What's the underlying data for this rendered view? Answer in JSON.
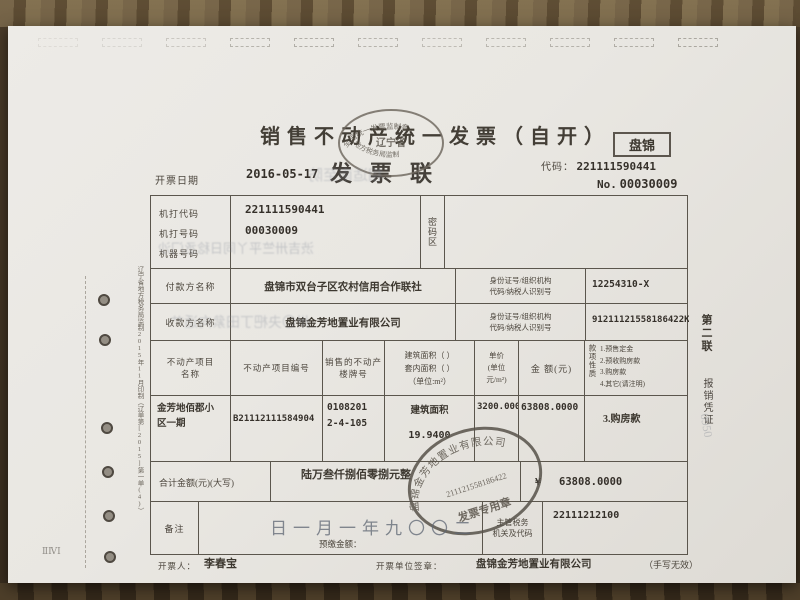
{
  "invoice": {
    "title": "销售不动产统一发票（自开）",
    "copy_label": "发票联",
    "region": "盘锦",
    "code_label": "代码：",
    "code": "221111590441",
    "number_label": "No.",
    "number": "00030009",
    "issue_date_label": "开票日期",
    "issue_date": "2016-05-17"
  },
  "supervision_stamp": {
    "arc_top": "全国统一发票监制章",
    "center": "辽宁省",
    "arc_bottom": "地方税务局监制"
  },
  "machine_info": {
    "label_code": "机打代码",
    "label_number": "机打号码",
    "label_machine": "机器号码",
    "code": "221111590441",
    "number": "00030009",
    "password_area_label": "密码区"
  },
  "parties": {
    "payer": {
      "label": "付款方名称",
      "name": "盘锦市双台子区农村信用合作联社",
      "id_label_line1": "身份证号/组织机构",
      "id_label_line2": "代码/纳税人识别号",
      "id": "12254310-X"
    },
    "payee": {
      "label": "收款方名称",
      "name": "盘锦金芳地置业有限公司",
      "id_label_line1": "身份证号/组织机构",
      "id_label_line2": "代码/纳税人识别号",
      "id": "91211121558186422K"
    }
  },
  "items": {
    "headers": {
      "project_name_line1": "不动产项目",
      "project_name_line2": "名称",
      "project_no": "不动产项目编号",
      "building_no_line1": "销售的不动产",
      "building_no_line2": "楼牌号",
      "area_line1": "建筑面积（ ）",
      "area_line2": "套内面积（ ）",
      "area_line3": "（单位:m²）",
      "unit_price_line1": "单价",
      "unit_price_line2": "(单位",
      "unit_price_line3": "元/m²)",
      "amount": "金 额(元)",
      "payment_nature_label": "款项性质",
      "payment_option_1": "1.预售定金",
      "payment_option_2": "2.预收购房款",
      "payment_option_3": "3.购房款",
      "payment_option_4": "4.其它(请注明)"
    },
    "row": {
      "project_name_line1": "金芳地佰郡小",
      "project_name_line2": "区一期",
      "project_no": "B21112111584904",
      "building_no_line1": "0108201",
      "building_no_line2": "2-4-105",
      "area_caption": "建筑面积",
      "area_value": "19.9400",
      "unit_price": "3200.0000",
      "amount": "63808.0000",
      "payment_nature": "3.购房款"
    }
  },
  "totals": {
    "label": "合计金额(元)(大写)",
    "in_words": "陆万叁仟捌佰零捌元整",
    "currency_symbol": "¥",
    "numeric": "63808.0000"
  },
  "remarks": {
    "label": "备注",
    "prepaid_label": "预缴金额：",
    "tax_authority_line1": "主管税务",
    "tax_authority_line2": "机关及代码",
    "tax_authority_code": "22111212100"
  },
  "company_stamp": {
    "arc": "盘锦金芳地置业有限公司",
    "center": "211121558186422",
    "caption": "发票专用章"
  },
  "footer": {
    "issuer_label": "开票人：",
    "issuer": "李春宝",
    "unit_label": "开票单位签章：",
    "unit": "盘锦金芳地置业有限公司",
    "note": "（手写无效）"
  },
  "side_labels": {
    "left_print_info": "辽宁省地方税务局监制2015年11月印制（辽单第[2015]第一单(4)）",
    "right_copy_line1": "第二联",
    "right_copy_line2": "报销凭证"
  },
  "bleed_artifacts": {
    "ghost_title_row": "相适南至防",
    "ghost_machine_row": "渋吉卅竺平丫同日稔丞门沙",
    "ghost_payee_row": "卅〇夬杷丁田絫向适艹",
    "ghost_remark_date": "日一月一年九〇〇二",
    "ghost_scribble": "0950",
    "edge_mark": "ⅡⅣⅠ"
  }
}
